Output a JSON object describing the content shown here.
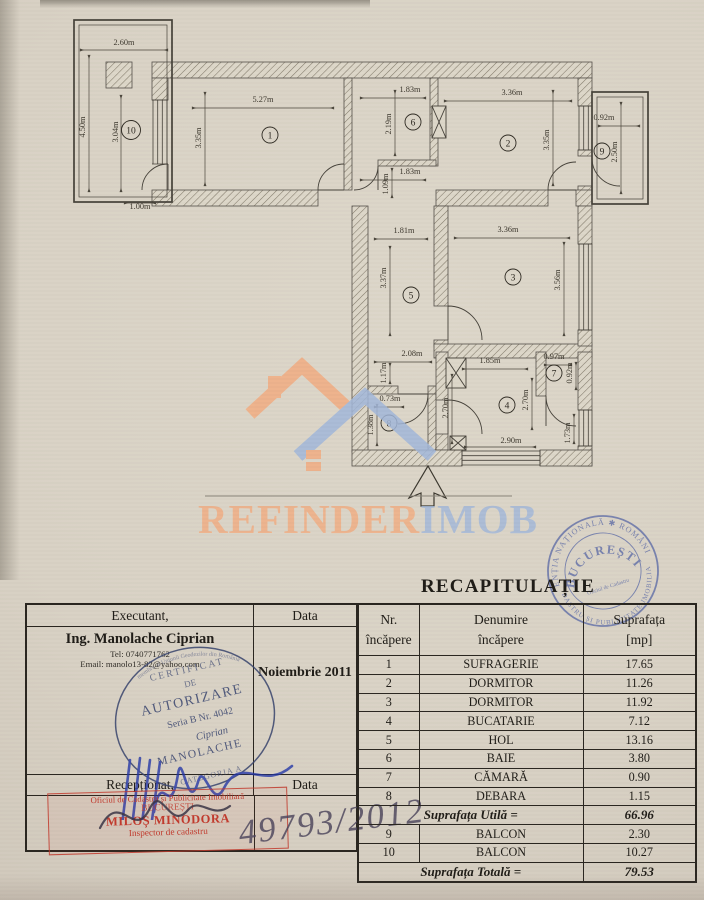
{
  "document": {
    "recap_title": "RECAPITULAȚIE",
    "handwritten_number": "49793/2012"
  },
  "floorplan": {
    "dims": [
      "2.60m",
      "4.50m",
      "3.04m",
      "1.00m",
      "5.27m",
      "3.35m",
      "1.83m",
      "2.19m",
      "1.83m",
      "1.09m",
      "3.36m",
      "3.35m",
      "0.92m",
      "2.50m",
      "1.81m",
      "3.37m",
      "3.36m",
      "3.56m",
      "2.08m",
      "1.17m",
      "0.73m",
      "1.38m",
      "1.85m",
      "2.70m",
      "2.70m",
      "0.97m",
      "0.92m",
      "2.90m",
      "1.73m"
    ],
    "rooms": [
      "10",
      "1",
      "6",
      "2",
      "9",
      "5",
      "3",
      "8",
      "4",
      "7"
    ]
  },
  "watermark": {
    "brand_left": "REFINDER",
    "brand_right": "IMOB",
    "orange": "#f2ae83",
    "blue": "#a3b8da"
  },
  "round_stamp": {
    "ring_top": "AGENȚIA NAȚIONALĂ ✱ ROMÂNIA ✱",
    "ring_bottom": "CADASTRU ȘI PUBLICITATE IMOBILIARĂ",
    "center": "BUCUREȘTI",
    "sub": "Oficiul de Cadastru",
    "color": "#5565a5"
  },
  "executant": {
    "header_left": "Executant,",
    "header_right": "Data",
    "name": "Ing. Manolache Ciprian",
    "tel": "Tel: 0740771762",
    "email": "Email: manolo13-82@yahoo.com",
    "date": "Noiembrie 2011",
    "recep_left": "Recepționat,",
    "recep_right": "Data"
  },
  "auth_stamp": {
    "l1": "CERTIFICAT",
    "l2": "DE",
    "l3": "AUTORIZARE",
    "l4": "Seria B Nr. 4042",
    "l5": "Ciprian",
    "l6": "MANOLACHE",
    "l7": "CATEGORIA A",
    "ring": "membru al Uniunii Geodezilor din România"
  },
  "red_stamp": {
    "l1": "Oficiul de Cadastru și Publicitate Imobiliară",
    "l2": "BUCUREȘTI",
    "l3": "MILOȘ MINODORA",
    "l4": "Inspector de cadastru"
  },
  "recap_table": {
    "header": {
      "c1a": "Nr.",
      "c1b": "încăpere",
      "c2a": "Denumire",
      "c2b": "încăpere",
      "c3a": "Suprafața",
      "c3b": "[mp]"
    },
    "rows": [
      {
        "nr": "1",
        "name": "SUFRAGERIE",
        "mp": "17.65"
      },
      {
        "nr": "2",
        "name": "DORMITOR",
        "mp": "11.26"
      },
      {
        "nr": "3",
        "name": "DORMITOR",
        "mp": "11.92"
      },
      {
        "nr": "4",
        "name": "BUCATARIE",
        "mp": "7.12"
      },
      {
        "nr": "5",
        "name": "HOL",
        "mp": "13.16"
      },
      {
        "nr": "6",
        "name": "BAIE",
        "mp": "3.80"
      },
      {
        "nr": "7",
        "name": "CĂMARĂ",
        "mp": "0.90"
      },
      {
        "nr": "8",
        "name": "DEBARA",
        "mp": "1.15"
      }
    ],
    "utila_label": "Suprafața Utilă  =",
    "utila_value": "66.96",
    "balcony_rows": [
      {
        "nr": "9",
        "name": "BALCON",
        "mp": "2.30"
      },
      {
        "nr": "10",
        "name": "BALCON",
        "mp": "10.27"
      }
    ],
    "totala_label": "Suprafața Totală  =",
    "totala_value": "79.53"
  }
}
